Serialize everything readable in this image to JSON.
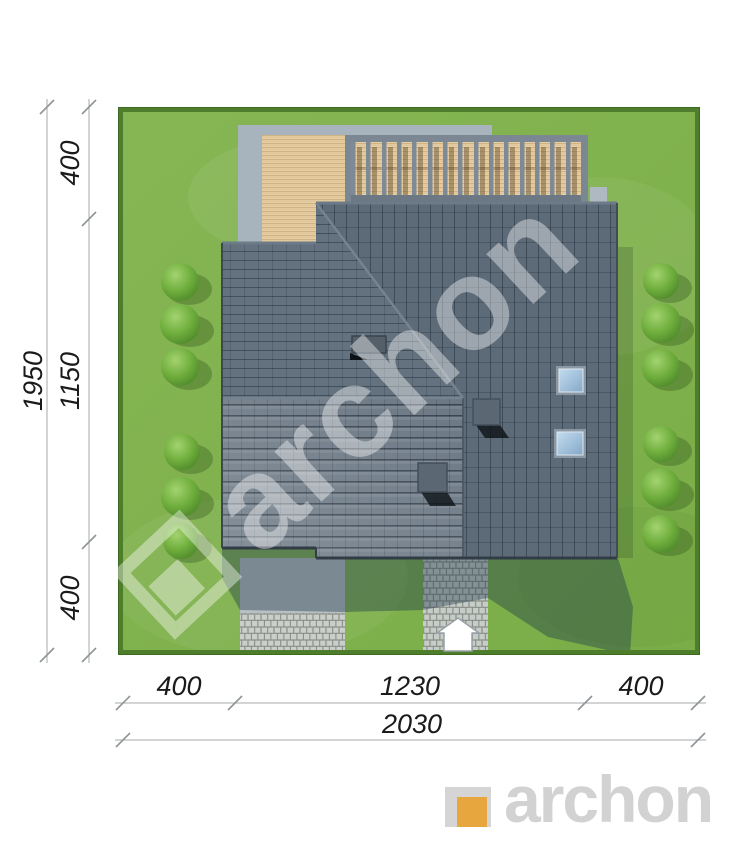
{
  "site_plan": {
    "watermark_text": "archon"
  },
  "dimensions": {
    "left": {
      "total": "1950",
      "segment_top": "400",
      "segment_middle": "1150",
      "segment_bottom": "400"
    },
    "bottom": {
      "segment_left": "400",
      "segment_middle": "1230",
      "segment_right": "400",
      "total": "2030"
    }
  },
  "branding": {
    "logo_text": "archon"
  },
  "palette": {
    "lawn_green": "#7fb24a",
    "hedge_green": "#4e7e2b",
    "roof_slate": "#5d6b79",
    "deck_wood": "#e6cfa4",
    "pergola_gray": "#7b8894",
    "paving_light": "#cbcfc9",
    "concrete_pad": "#a7b4bd",
    "skylight_blue": "#a9c8e4",
    "cast_shadow": "rgba(30,55,72,0.40)",
    "logo_orange": "#e8a63f",
    "logo_gray": "#d2d2d2",
    "dimension_line": "#a6a9ab",
    "dimension_text": "#1b1b1b"
  }
}
